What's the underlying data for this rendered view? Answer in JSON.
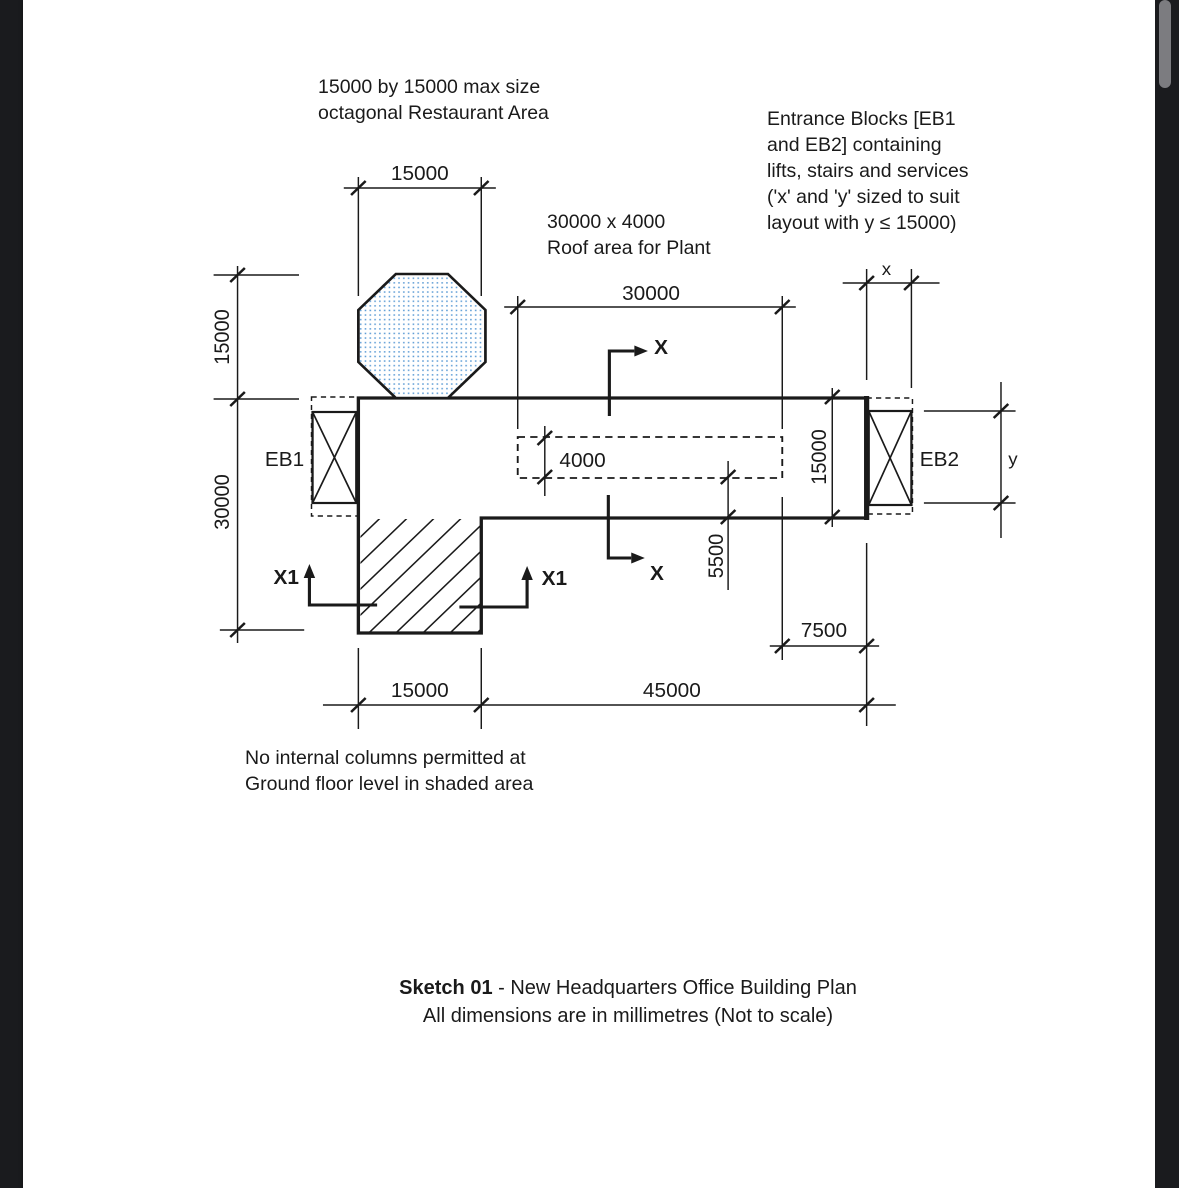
{
  "annotations": {
    "restaurant": {
      "lines": [
        "15000 by 15000 max size",
        "octagonal Restaurant Area"
      ]
    },
    "roof_plant": {
      "lines": [
        "30000 x 4000",
        "Roof area for Plant"
      ]
    },
    "entrance_blocks": {
      "lines": [
        "Entrance Blocks [EB1",
        "and EB2] containing",
        "lifts, stairs and services",
        "('x' and 'y' sized to suit",
        "layout with y ≤ 15000)"
      ]
    },
    "no_columns": {
      "lines": [
        "No internal columns permitted at",
        "Ground floor level in shaded area"
      ]
    }
  },
  "dimensions": {
    "octagon_width": "15000",
    "left_upper_height": "15000",
    "left_lower_height": "30000",
    "roof_width": "30000",
    "roof_depth": "4000",
    "plant_offset": "5500",
    "right_height": "15000",
    "eb_width": "x",
    "eb_height": "y",
    "roof_edge_offset": "7500",
    "bottom_wing_width": "15000",
    "bottom_main_width": "45000"
  },
  "labels": {
    "eb1": "EB1",
    "eb2": "EB2",
    "section_x_top": "X",
    "section_x_bottom": "X",
    "section_x1_left": "X1",
    "section_x1_right": "X1"
  },
  "caption": {
    "title_bold": "Sketch 01",
    "title_rest": " - New Headquarters Office Building Plan",
    "subtitle": "All dimensions are in millimetres (Not to scale)"
  },
  "colors": {
    "line": "#1a1a1a",
    "octagon_dots": "#5b9bd5",
    "paper": "#ffffff",
    "frame": "#1a1b1e",
    "scrollbar": "#7c7c80"
  }
}
